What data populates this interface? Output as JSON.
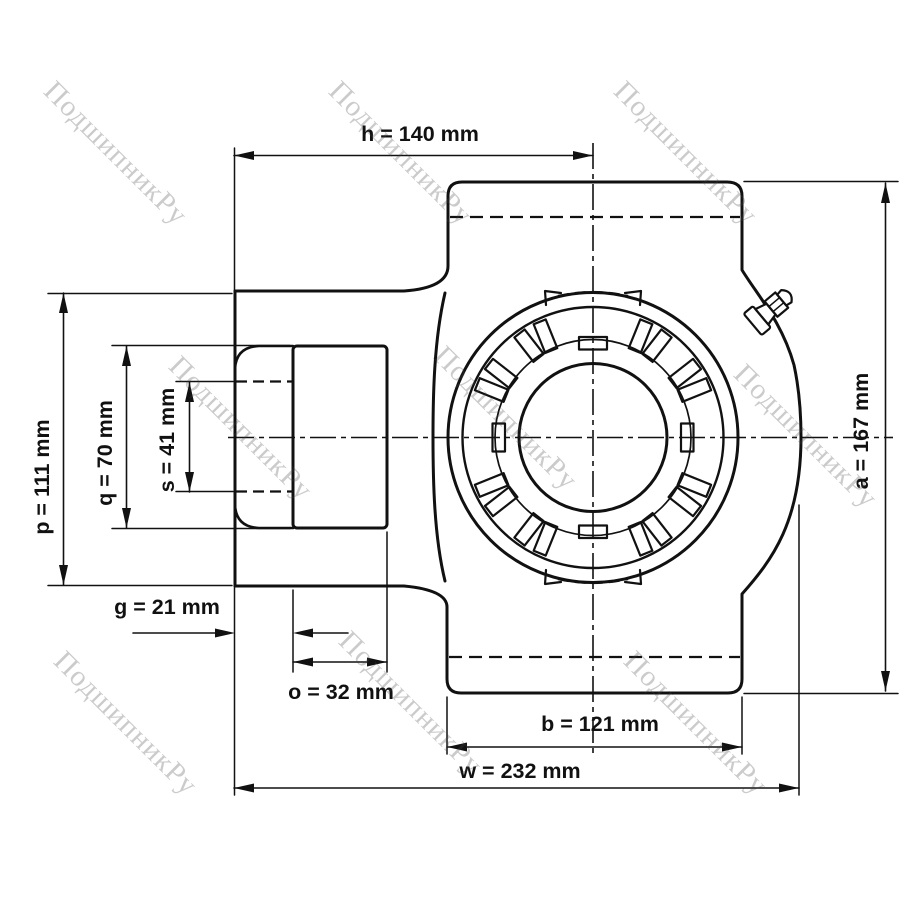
{
  "watermark": {
    "text": "ПодшипникРу"
  },
  "colors": {
    "line": "#111111",
    "shaft_fill": "#d8d8d8"
  },
  "dimensions": {
    "h": {
      "name": "h",
      "value": 140,
      "unit": "mm",
      "label": "h = 140 mm"
    },
    "p": {
      "name": "p",
      "value": 111,
      "unit": "mm",
      "label": "p = 111 mm"
    },
    "q": {
      "name": "q",
      "value": 70,
      "unit": "mm",
      "label": "q = 70 mm"
    },
    "s": {
      "name": "s",
      "value": 41,
      "unit": "mm",
      "label": "s = 41 mm"
    },
    "g": {
      "name": "g",
      "value": 21,
      "unit": "mm",
      "label": "g = 21 mm"
    },
    "o": {
      "name": "o",
      "value": 32,
      "unit": "mm",
      "label": "o = 32 mm"
    },
    "b": {
      "name": "b",
      "value": 121,
      "unit": "mm",
      "label": "b = 121 mm"
    },
    "w": {
      "name": "w",
      "value": 232,
      "unit": "mm",
      "label": "w = 232 mm"
    },
    "a": {
      "name": "a",
      "value": 167,
      "unit": "mm",
      "label": "a = 167 mm"
    }
  }
}
